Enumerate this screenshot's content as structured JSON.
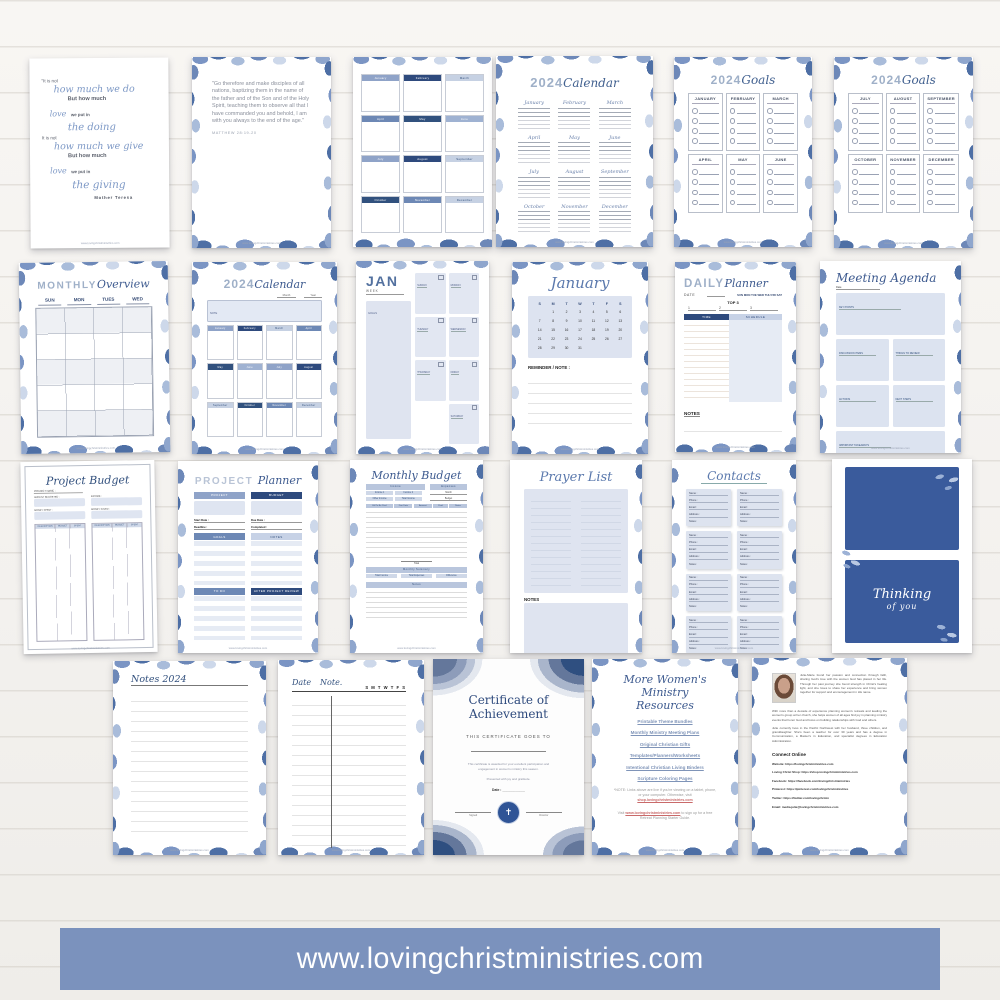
{
  "banner": {
    "text": "www.lovingchristministries.com",
    "bg": "#7b92bd"
  },
  "footer_url": "www.lovingchristministries.com",
  "months": [
    "January",
    "February",
    "March",
    "April",
    "May",
    "June",
    "July",
    "August",
    "September",
    "October",
    "November",
    "December"
  ],
  "quote": {
    "l1": "\"It is not",
    "l2": "how much we do",
    "l3": "But how much",
    "l4a": "love",
    "l4b": "we put in",
    "l5": "the doing",
    "l6": "It is not",
    "l7": "how much we give",
    "l8": "But how much",
    "l9a": "love",
    "l9b": "we put in",
    "l10": "the giving",
    "author": "Mother Teresa"
  },
  "scripture": {
    "text": "\"Go therefore and make disciples of all nations, baptizing them in the name of the father and of the Son and of the Holy Spirit, teaching them to observe all that I have commanded you and behold, I am with you always to the end of the age.\"",
    "ref": "MATTHEW 28:19-20"
  },
  "year_cal": {
    "year": "2024",
    "word": "Calendar"
  },
  "goals": {
    "year": "2024",
    "word": "Goals",
    "first_half": [
      "JANUARY",
      "FEBRUARY",
      "MARCH",
      "APRIL",
      "MAY",
      "JUNE"
    ],
    "second_half": [
      "JULY",
      "AUGUST",
      "SEPTEMBER",
      "OCTOBER",
      "NOVEMBER",
      "DECEMBER"
    ]
  },
  "overview": {
    "title_a": "MONTHLY",
    "title_b": "Overview",
    "days": [
      "SUN",
      "MON",
      "TUES",
      "WED"
    ]
  },
  "cal2024": {
    "year": "2024",
    "word": "Calendar",
    "note_label": "NOTE",
    "month_label": "Month",
    "year_label": "Year"
  },
  "jan_week": {
    "month": "JAN",
    "week_label": "WEEK",
    "goals_label": "GOALS",
    "days": [
      "SUNDAY",
      "MONDAY",
      "TUESDAY",
      "WEDNESDAY",
      "THURSDAY",
      "FRIDAY",
      "SATURDAY"
    ]
  },
  "january": {
    "title": "January",
    "dow": [
      "S",
      "M",
      "T",
      "W",
      "T",
      "F",
      "S"
    ],
    "cells": [
      "",
      "1",
      "2",
      "3",
      "4",
      "5",
      "6",
      "7",
      "8",
      "9",
      "10",
      "11",
      "12",
      "13",
      "14",
      "15",
      "16",
      "17",
      "18",
      "19",
      "20",
      "21",
      "22",
      "23",
      "24",
      "25",
      "26",
      "27",
      "28",
      "29",
      "30",
      "31",
      "",
      "",
      ""
    ],
    "reminder": "REMINDER / NOTE :"
  },
  "daily": {
    "title_a": "DAILY",
    "title_b": "Planner",
    "date_label": "DATE",
    "days": "SUN MON TUE WED THU FRI SAT",
    "top3": "TOP 3",
    "nums": [
      "1",
      "2",
      "3"
    ],
    "col_time": "TIME",
    "col_schedule": "SCHEDULE",
    "notes": "NOTES"
  },
  "meeting": {
    "title": "Meeting Agenda",
    "date_label": "Date",
    "boxes": [
      "KEY POINTS",
      "DISCUSSION ITEMS",
      "THINGS TO REVIEW",
      "ACTIONS",
      "NEXT STEPS",
      "IMPORTANT TAKEAWAYS"
    ]
  },
  "proj_budget": {
    "title": "Project Budget",
    "f1": "PROJECT NAME :",
    "f2": "AMOUNT BUDGETED :",
    "f3": "INCOME :",
    "f4": "MONEY SPENT :",
    "f5": "MONEY SAVED :",
    "cols": [
      "DESCRIPTION",
      "BUDGET",
      "SPENT"
    ]
  },
  "proj_planner": {
    "title_a": "PROJECT",
    "title_b": "Planner",
    "bar_project": "PROJECT",
    "bar_budget": "BUDGET",
    "f_start": "Start Date :",
    "f_due": "Due Date :",
    "f_deadline": "Deadline :",
    "f_completed": "Completed :",
    "bar_goals": "GOALS",
    "bar_notes": "NOTES",
    "bar_todo": "TO DO",
    "bar_review": "AFTER PROJECT REVIEW"
  },
  "mon_budget": {
    "title": "Monthly Budget",
    "income": "Income",
    "expenses": "Expenses",
    "month": "Month",
    "budget": "Budget",
    "rows": [
      "Income 1",
      "Income 2",
      "Other Income",
      "Total Income"
    ],
    "bill_cols": [
      "Bill To Be Paid",
      "Due Date",
      "Amount",
      "Paid",
      "Notes"
    ],
    "total": "Total",
    "summary": "Monthly Summary",
    "sum_cols": [
      "Total Income",
      "Total Expenses",
      "Difference"
    ],
    "notes": "Notes"
  },
  "prayer": {
    "title": "Prayer List",
    "notes": "NOTES"
  },
  "contacts": {
    "title": "Contacts",
    "fields": [
      "Name :",
      "Phone :",
      "Email :",
      "Address :",
      "Notes :"
    ],
    "cards": [
      1,
      2,
      3,
      4,
      5,
      6,
      7,
      8
    ]
  },
  "thinking": {
    "l1": "Thinking",
    "l2": "of you"
  },
  "notes2024": {
    "title": "Notes 2024"
  },
  "datenote": {
    "a": "Date",
    "b": "Note.",
    "days": "S M T W T F S"
  },
  "certificate": {
    "t1": "Certificate of",
    "t2": "Achievement",
    "goes": "THIS CERTIFICATE GOES TO",
    "body": "This certificate is awarded for your excellent participation and engagement in women's ministry this season.",
    "presented": "Presented with joy and gratitude.",
    "date": "Date :",
    "sig1": "Signed",
    "sig2": "Director"
  },
  "resources": {
    "t1": "More Women's",
    "t2": "Ministry Resources",
    "links": [
      "Printable Theme Bundles",
      "Monthly Ministry Meeting Plans",
      "Original Christian Gifts",
      "Templates/Planners/Worksheets",
      "Intentional Christian Living Binders",
      "Scripture Coloring Pages"
    ],
    "note_pre": "*NOTE: Links above are live if you're viewing on a tablet, phone, or your computer. Otherwise, visit",
    "note_link": "shop.lovingchristministries.com",
    "visit_pre": "Visit",
    "visit_link": "www.lovingchristministries.com",
    "visit_post": "to sign up for a free Retreat Planning Starter Guide."
  },
  "about": {
    "p1": "Julie-Marie found her passion and connection through faith, sharing God's love with the women God has placed in her life. Through her past journey she found strength in Christ's healing light, and she loves to share her experience and bring women together for support and encouragement in His name.",
    "p2": "With more than a decade of experience planning women's retreats and leading the women's group at her church, she helps women of all ages find joy in planning ministry events that honor God and focus on building relationships with God and others.",
    "p3": "Julie currently lives in the Pacific Northwest with her husband, three children, and granddaughter. She's been a teacher for over 30 years and has a degree in Communication, a Master's in Education, and specialist degrees in Education Administration.",
    "connect": "Connect Online",
    "lines": [
      "Website: https://lovingchristministries.com",
      "Loving Christ Shop: https://shop.lovingchristministries.com",
      "Facebook: https://facebook.com/lovingchristministries",
      "Pinterest: https://pinterest.com/lovingchristministries",
      "Twitter: https://twitter.com/lovingchrmin",
      "Email: media.julie@lovingchristministries.com"
    ]
  }
}
